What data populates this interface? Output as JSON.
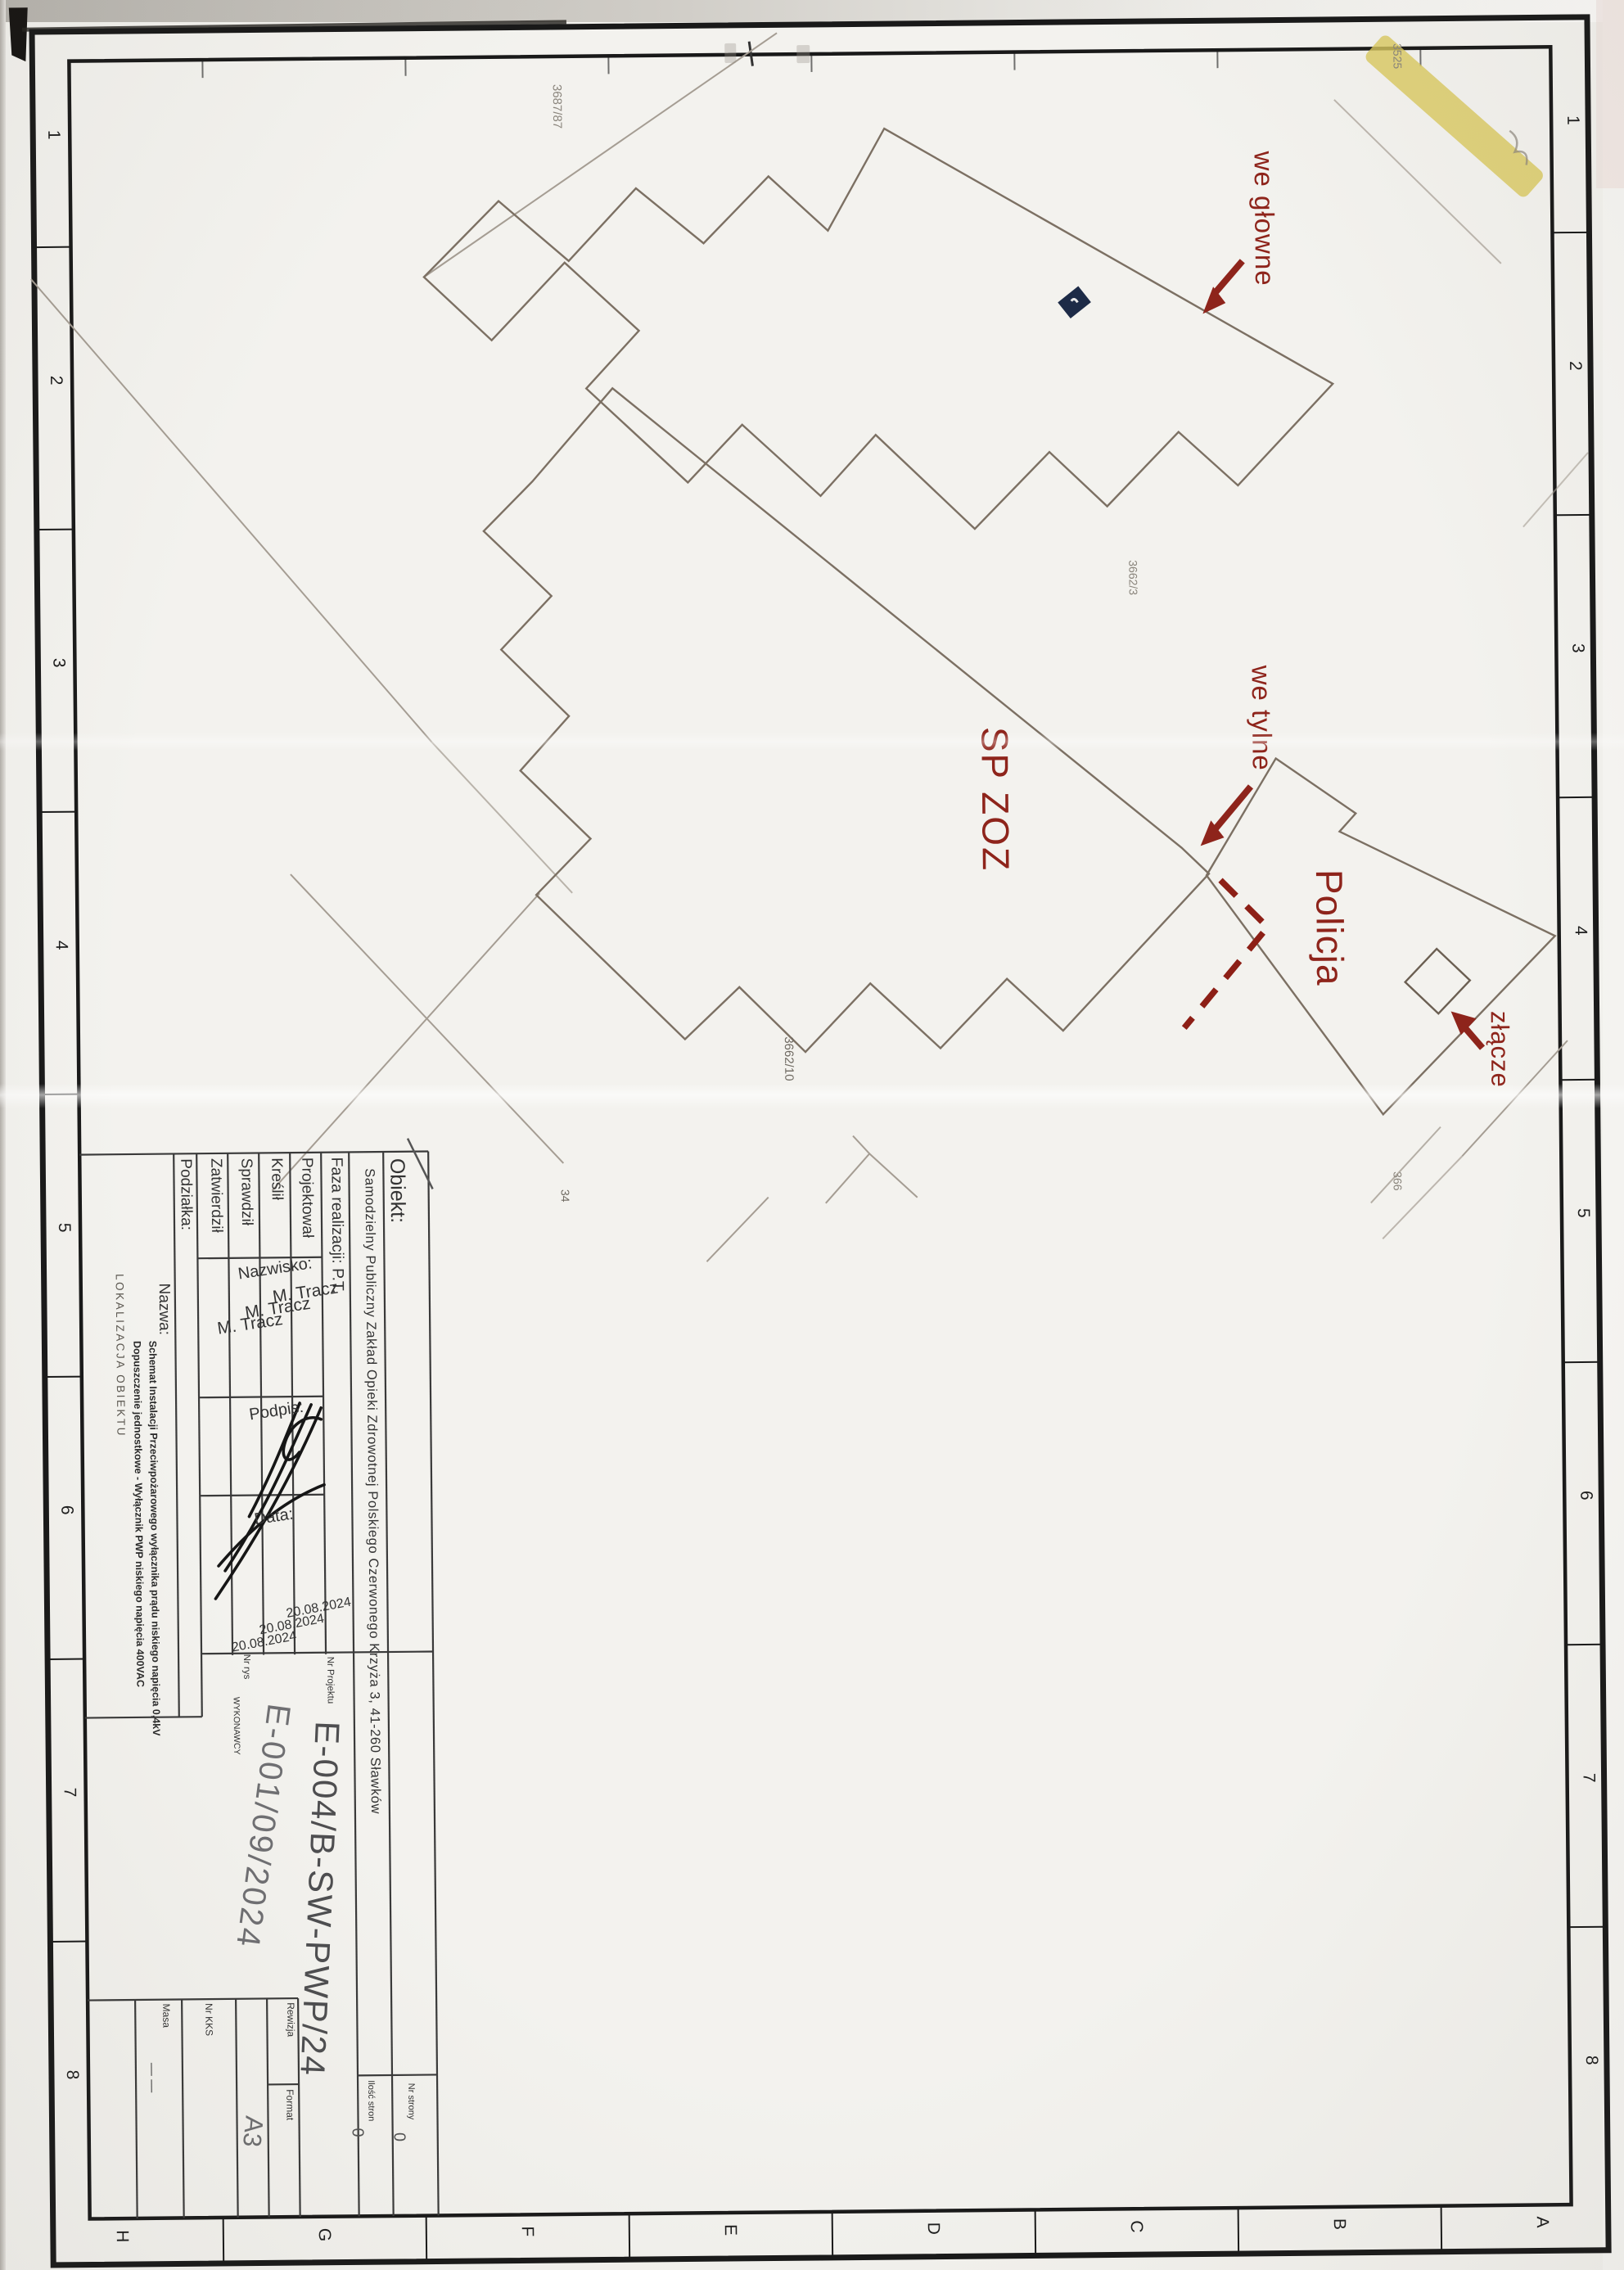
{
  "drawing": {
    "annotations": {
      "main_entrance": "we głowne",
      "rear_entrance": "we tylne",
      "junction": "złącze",
      "building_spzoz": "SP ZOZ",
      "building_policja": "Policja"
    },
    "parcels": {
      "p3687": "3687/87",
      "p3525": "3525",
      "p3662_3": "3662/3",
      "p3662_10": "3662/10",
      "p34": "34",
      "p366": "366"
    },
    "colors": {
      "annotation_red": "#8e241b",
      "building_line": "#7c7063",
      "street_line": "#a59d93",
      "highlight_yellow": "#d9c85e",
      "marker_navy": "#1d2b47",
      "frame_black": "#191919"
    }
  },
  "frame": {
    "zone_numbers": [
      "1",
      "2",
      "3",
      "4",
      "5",
      "6",
      "7",
      "8"
    ],
    "zone_letters": [
      "H",
      "G",
      "F",
      "E",
      "D",
      "C",
      "B",
      "A"
    ]
  },
  "title_block": {
    "obiekt_label": "Obiekt:",
    "obiekt_value": "Samodzielny Publiczny Zakład Opieki Zdrowotnej Polskiego Czerwonego Krzyża 3, 41-260 Sławków",
    "faza": "Faza realizacji: P.T.",
    "rows": [
      {
        "role": "Projektował",
        "name": "M. Tracz",
        "date": "20.08.2024"
      },
      {
        "role": "Kreślił",
        "name": "M. Tracz",
        "date": "20.08.2024"
      },
      {
        "role": "Sprawdził",
        "name": "M. Tracz",
        "date": "20.08.2024"
      },
      {
        "role": "Zatwierdził",
        "name": "",
        "date": ""
      }
    ],
    "nazwisko_label": "Nazwisko:",
    "podpis_label": "Podpis:",
    "data_label": "Data:",
    "podzialka_label": "Podziałka:",
    "nazwa_label": "Nazwa:",
    "nazwa_line1": "Schemat Instalacji Przeciwpożarowego wyłącznika prądu niskiego napięcia 0,4kV",
    "nazwa_line2": "Dopuszczenie jednostkowe - Wyłącznik PWP niskiego napięcia 400VAC",
    "lokalizacja": "LOKALIZACJA OBIEKTU",
    "nr_projektu_label": "Nr Projektu",
    "nr_projektu": "E-004/B-SW-PWP/24",
    "nr_rys_label": "Nr rys",
    "nr_rys_wykonawcy_label": "WYKONAWCY",
    "nr_rys": "E-001/09/2024",
    "rewizja_label": "Rewizja",
    "format_label": "Format",
    "format_value": "A3",
    "nr_kks_label": "Nr KKS",
    "masa_label": "Masa",
    "masa_value": "— —",
    "nr_strony_label": "Nr strony",
    "nr_strony_value": "0",
    "ilosc_stron_label": "Ilość stron",
    "ilosc_stron_value": "0"
  }
}
